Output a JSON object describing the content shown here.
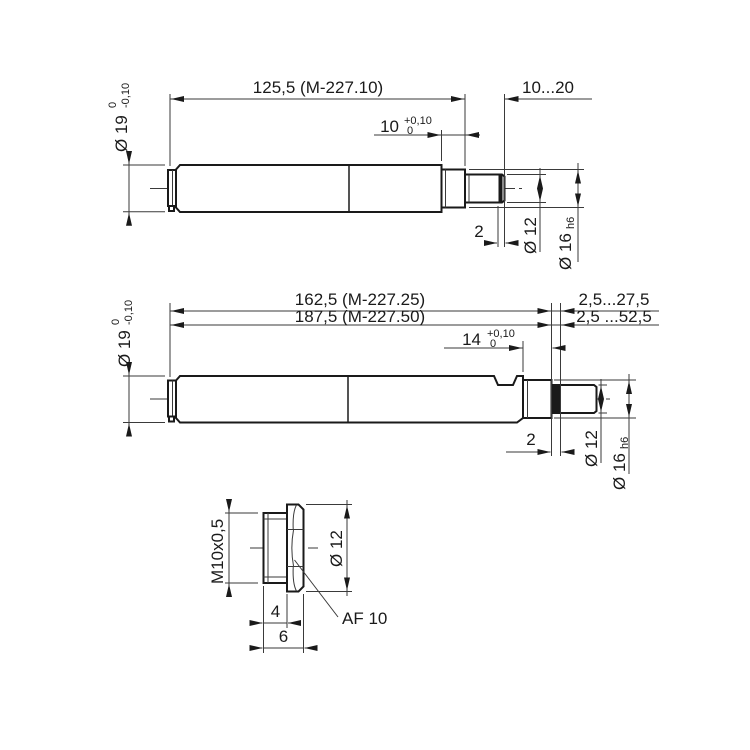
{
  "top": {
    "overall": "125,5 (M-227.10)",
    "range": "10...20",
    "step_len": "10",
    "step_tol_top": "+0,10",
    "step_tol_bottom": "0",
    "dia_body": "Ø 19",
    "dia_body_tol_top": "0",
    "dia_body_tol_bottom": "-0,10",
    "groove": "2",
    "dia_tip": "Ø 12",
    "dia_collar": "Ø 16",
    "dia_collar_fit": "h6"
  },
  "middle": {
    "overall_1": "162,5 (M-227.25)",
    "overall_2": "187,5 (M-227.50)",
    "range_1": "2,5...27,5",
    "range_2": "2,5 ...52,5",
    "step_len": "14",
    "step_tol_top": "+0,10",
    "step_tol_bottom": "0",
    "dia_body": "Ø 19",
    "dia_body_tol_top": "0",
    "dia_body_tol_bottom": "-0,10",
    "groove": "2",
    "dia_tip": "Ø 12",
    "dia_collar": "Ø 16",
    "dia_collar_fit": "h6"
  },
  "detail": {
    "thread": "M10x0,5",
    "dia_head": "Ø 12",
    "thread_len": "4",
    "total_len": "6",
    "wrench": "AF 10"
  }
}
